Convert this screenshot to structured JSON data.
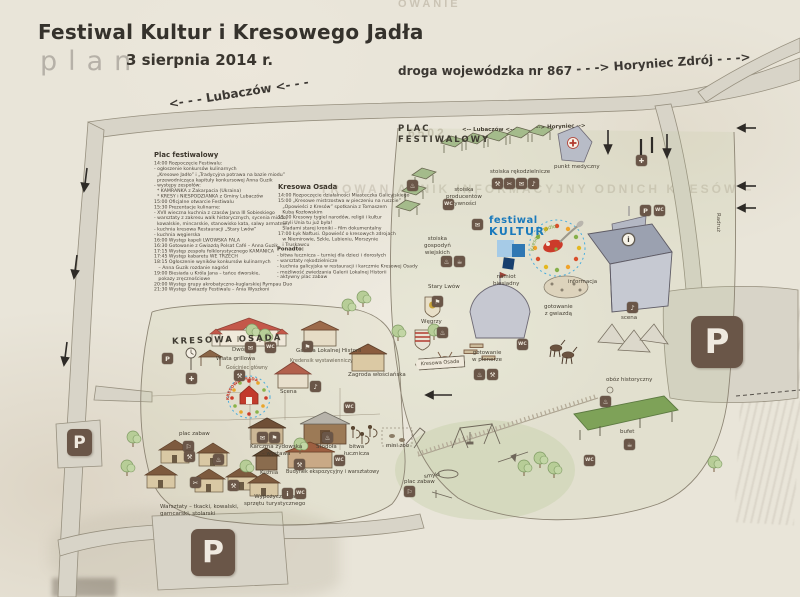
{
  "header": {
    "title": "Festiwal Kultur i Kresowego Jadła",
    "plan_label": "plan",
    "date": "3 sierpnia 2014 r."
  },
  "roads": {
    "voivodeship": "droga wojewódzka nr 867",
    "horyniec": "- - -> Horyniec Zdrój - - ->",
    "lubaczow": "<- - - Lubaczów <- - -",
    "horyniec_small": "--> Horyniec -->",
    "lubaczow_small": "<-- Lubaczów <--",
    "radruz": "Radruż"
  },
  "programs": {
    "plac": {
      "title": "Plac festiwalowy",
      "lines": [
        "14:00 Rozpoczęcie Festiwalu:",
        "- ogłoszenie konkursów kulinarnych",
        "  „Kresowe Jadło” i „Tradycyjna potrawa na bazie miodu”",
        "  przewodnicząca kapituły konkursowej Anna Guzik",
        "- występy zespołów:",
        "  * KAMRANKA z Zakarpacia (Ukraina)",
        "  * KRESY i NIESPODZIANKA z Gminy Lubaczów",
        "15:00 Oficjalne otwarcie Festiwalu",
        "15:30 Prezentacje kulinarne:",
        "- XVII wieczna kuchnia z czasów Jana III Sobieskiego",
        "- warsztaty z zakresu walk historycznych, sycenia miodu,",
        "  kowalskie, mincarskie, stanowisko kata, salwy armatnie",
        "- kuchnia kresowa Restauracji „Stary Lwów”",
        "- kuchnia węgierska",
        "16:00 Występ kapeli LWOWSKA FALA",
        "16:30 Gotowanie z Gwiazdą Polsat Café – Anna Guzik",
        "17:15 Występ zespołu folklorystycznego KAMANICA",
        "17:45 Występ kabaretu WE TRZECH",
        "18:15 Ogłoszenie wyników konkursów kulinarnych",
        "   – Anna Guzik rozdanie nagród",
        "19:00 Biesiada u Króla Jana – tańce dworskie,",
        "   pokazy zręcznościowe",
        "20:00 Występ grupy akrobatyczno-kuglarskiej Rympau Duo",
        "21:30 Występ Gwiazdy Festiwalu – Ania Wyszkoni"
      ]
    },
    "osada": {
      "title": "Kresowa Osada",
      "lines": [
        "14:00 Rozpoczęcie działalności Miasteczka Galicyjskiego",
        "15:00 „Kresowe mistrzostwa w pieczeniu na ruszcie”",
        "   „Opowieści z Kresów” spotkania z Tomaszem",
        "   Kubą Kozłowskim",
        "15:00 Kresowy tygiel narodów, religii i kultur",
        "   czyli Unia tu już była!",
        "   Śladami starej kroniki – film dokumentalny",
        "17:00 Łyk Naftusi. Opowieść o kresowych zdrojach",
        "   w Niemirowie, Szkle, Lubieniu, Morszynie",
        "   i Truskawcu"
      ]
    },
    "ponadto": {
      "title": "Ponadto:",
      "lines": [
        "- bitwa łucznicza – turniej dla dzieci i dorosłych",
        "- warsztaty rękodzielnicze",
        "- kuchnia galicyjska w restauracji i karczmie Kresowej Osady",
        "- możliwość zwiedzania Galerii Lokalnej Historii",
        "- aktywny plac zabaw"
      ]
    }
  },
  "map_labels": {
    "plac_festiwalowy": "PLAC\nFESTIWALOWY",
    "stoiska_rekodzielnicze": "stoiska rękodzielnicze",
    "punkt_medyczny": "punkt medyczny",
    "stoiska_producentow": "stoiska\nproducentów\nżywności",
    "stoiska_gospodyn": "stoiska\ngospodyń\nwiejskich",
    "informacja": "informacja",
    "namiot_biesiadny": "namiot\nbiesiadny",
    "stary_lwow": "Stary Lwów",
    "wegrzy": "Węgrzy",
    "gotowanie_z_gwiazda": "gotowanie\nz gwiazdą",
    "scena": "scena",
    "gotowanie_w_plenerze": "gotowanie\nw plenerze",
    "oboz_historyczny": "obóz historyczny",
    "bufet": "bufet",
    "mini_zoo": "mini zoo",
    "smyki": "smyki",
    "plac_zabaw": "plac zabaw",
    "kresowa_osada_header": "KRESOWA OSADA",
    "dwor": "Dwór",
    "wiata_grillowa": "Wiata grillowa",
    "gosciniec_glowny": "Gościniec główny",
    "galeria": "Galeria Lokalnej Historii",
    "kredens": "Kredensik wystawienniczy",
    "zagroda": "Zagroda włościańska",
    "scena_osada": "Scena",
    "karczma_zydowska": "Karczma żydowska\n– wystawa",
    "stodola": "Stodoła",
    "bitwa_lucznicza": "bitwa\nłucznicza",
    "kuznia": "Kuźnia",
    "budynek_ekspozycyjny": "Budynek ekspozycyjny i warsztatowy",
    "wypozyczalnia": "Wypożyczalnia\nsprzętu turystycznego",
    "warsztaty": "Warsztaty – tkacki, kowalski,\ngarncarski, stolarski",
    "plac_zabaw_osada": "plac zabaw",
    "kresowa_osada_sign": "Kresowa Osada"
  },
  "logos": {
    "festiwal_line1": "festiwal",
    "festiwal_line2": "KULTUR",
    "jadlo_arc_text": "Kresowe Jadło",
    "osada_arc_text": "KRESOWA OSADA"
  },
  "watermarks": {
    "w1": "OWANIE",
    "w2": "TROWAN      ANNIK INFORMACYJNY      ODNICH KRESÓW –",
    "w3": "6502."
  },
  "parking": {
    "label": "P"
  },
  "parkings": [
    {
      "x": 691,
      "y": 316,
      "w": 52,
      "h": 52,
      "fs": 34,
      "r": 9,
      "name": "parking-area-east"
    },
    {
      "x": 191,
      "y": 529,
      "w": 44,
      "h": 47,
      "fs": 30,
      "r": 7,
      "name": "parking-area-south"
    },
    {
      "x": 67,
      "y": 429,
      "w": 25,
      "h": 27,
      "fs": 17,
      "r": 5,
      "name": "parking-area-west"
    }
  ],
  "map_icons": [
    {
      "x": 492,
      "y": 178,
      "g": "⚒",
      "n": "craft-stall-icon-1"
    },
    {
      "x": 504,
      "y": 178,
      "g": "✂",
      "n": "craft-stall-icon-2"
    },
    {
      "x": 516,
      "y": 178,
      "g": "✉",
      "n": "craft-stall-icon-3"
    },
    {
      "x": 528,
      "y": 178,
      "g": "♪",
      "n": "craft-stall-icon-4"
    },
    {
      "x": 636,
      "y": 155,
      "g": "✚",
      "n": "firstaid-icon"
    },
    {
      "x": 443,
      "y": 199,
      "g": "WC",
      "n": "wc-icon-1"
    },
    {
      "x": 407,
      "y": 180,
      "g": "♨",
      "n": "food-stall-icon"
    },
    {
      "x": 472,
      "y": 219,
      "g": "✉",
      "n": "mail-icon-plac"
    },
    {
      "x": 441,
      "y": 256,
      "g": "♨",
      "n": "gospodynie-icon-1"
    },
    {
      "x": 454,
      "y": 256,
      "g": "☕",
      "n": "gospodynie-icon-2"
    },
    {
      "x": 432,
      "y": 296,
      "g": "⚑",
      "n": "stary-lwow-icon"
    },
    {
      "x": 437,
      "y": 327,
      "g": "♨",
      "n": "wegrzy-icon"
    },
    {
      "x": 627,
      "y": 302,
      "g": "♪",
      "n": "scena-icon"
    },
    {
      "x": 640,
      "y": 205,
      "g": "P",
      "n": "parking-small-icon"
    },
    {
      "x": 654,
      "y": 205,
      "g": "WC",
      "n": "wc-icon-2"
    },
    {
      "x": 517,
      "y": 339,
      "g": "WC",
      "n": "wc-icon-3"
    },
    {
      "x": 474,
      "y": 369,
      "g": "♨",
      "n": "plener-cooking-icon"
    },
    {
      "x": 487,
      "y": 369,
      "g": "⚒",
      "n": "plener-craft-icon"
    },
    {
      "x": 600,
      "y": 396,
      "g": "♨",
      "n": "oboz-icon"
    },
    {
      "x": 624,
      "y": 439,
      "g": "☕",
      "n": "bufet-icon"
    },
    {
      "x": 404,
      "y": 486,
      "g": "⚐",
      "n": "plac-zabaw-icon"
    },
    {
      "x": 584,
      "y": 455,
      "g": "WC",
      "n": "wc-icon-7"
    },
    {
      "x": 622,
      "y": 233,
      "g": "i",
      "n": "info-point-icon",
      "round": true
    },
    {
      "x": 162,
      "y": 353,
      "g": "P",
      "n": "parking-tiny-icon"
    },
    {
      "x": 186,
      "y": 373,
      "g": "✚",
      "n": "osada-firstaid-icon"
    },
    {
      "x": 234,
      "y": 370,
      "g": "⚒",
      "n": "osada-craft-icon"
    },
    {
      "x": 245,
      "y": 342,
      "g": "✉",
      "n": "dwor-icon-1"
    },
    {
      "x": 265,
      "y": 342,
      "g": "WC",
      "n": "dwor-icon-2"
    },
    {
      "x": 302,
      "y": 341,
      "g": "⚑",
      "n": "galeria-icon"
    },
    {
      "x": 310,
      "y": 381,
      "g": "♪",
      "n": "scena-osada-icon"
    },
    {
      "x": 344,
      "y": 402,
      "g": "WC",
      "n": "wc-icon-4"
    },
    {
      "x": 257,
      "y": 432,
      "g": "✉",
      "n": "karczma-icon-1"
    },
    {
      "x": 269,
      "y": 432,
      "g": "⚑",
      "n": "karczma-icon-2"
    },
    {
      "x": 294,
      "y": 459,
      "g": "⚒",
      "n": "kuznia-icon"
    },
    {
      "x": 334,
      "y": 455,
      "g": "WC",
      "n": "wc-icon-5"
    },
    {
      "x": 322,
      "y": 432,
      "g": "♨",
      "n": "stodola-icon"
    },
    {
      "x": 282,
      "y": 488,
      "g": "i",
      "n": "wypozyczalnia-info-icon"
    },
    {
      "x": 295,
      "y": 488,
      "g": "WC",
      "n": "wc-icon-6"
    },
    {
      "x": 183,
      "y": 441,
      "g": "⚐",
      "n": "plac-zabaw-osada-icon"
    },
    {
      "x": 184,
      "y": 451,
      "g": "⚒",
      "n": "warsztat-icon-1"
    },
    {
      "x": 213,
      "y": 454,
      "g": "♨",
      "n": "warsztat-icon-2"
    },
    {
      "x": 190,
      "y": 477,
      "g": "✂",
      "n": "warsztat-icon-3"
    },
    {
      "x": 228,
      "y": 480,
      "g": "⚒",
      "n": "warsztat-icon-4"
    }
  ],
  "trees": [
    {
      "x": 252,
      "y": 330
    },
    {
      "x": 265,
      "y": 335
    },
    {
      "x": 348,
      "y": 305
    },
    {
      "x": 363,
      "y": 297
    },
    {
      "x": 398,
      "y": 331
    },
    {
      "x": 434,
      "y": 330
    },
    {
      "x": 300,
      "y": 444
    },
    {
      "x": 246,
      "y": 466
    },
    {
      "x": 133,
      "y": 437
    },
    {
      "x": 127,
      "y": 466
    },
    {
      "x": 524,
      "y": 466
    },
    {
      "x": 540,
      "y": 458
    },
    {
      "x": 554,
      "y": 468
    },
    {
      "x": 714,
      "y": 462
    }
  ]
}
